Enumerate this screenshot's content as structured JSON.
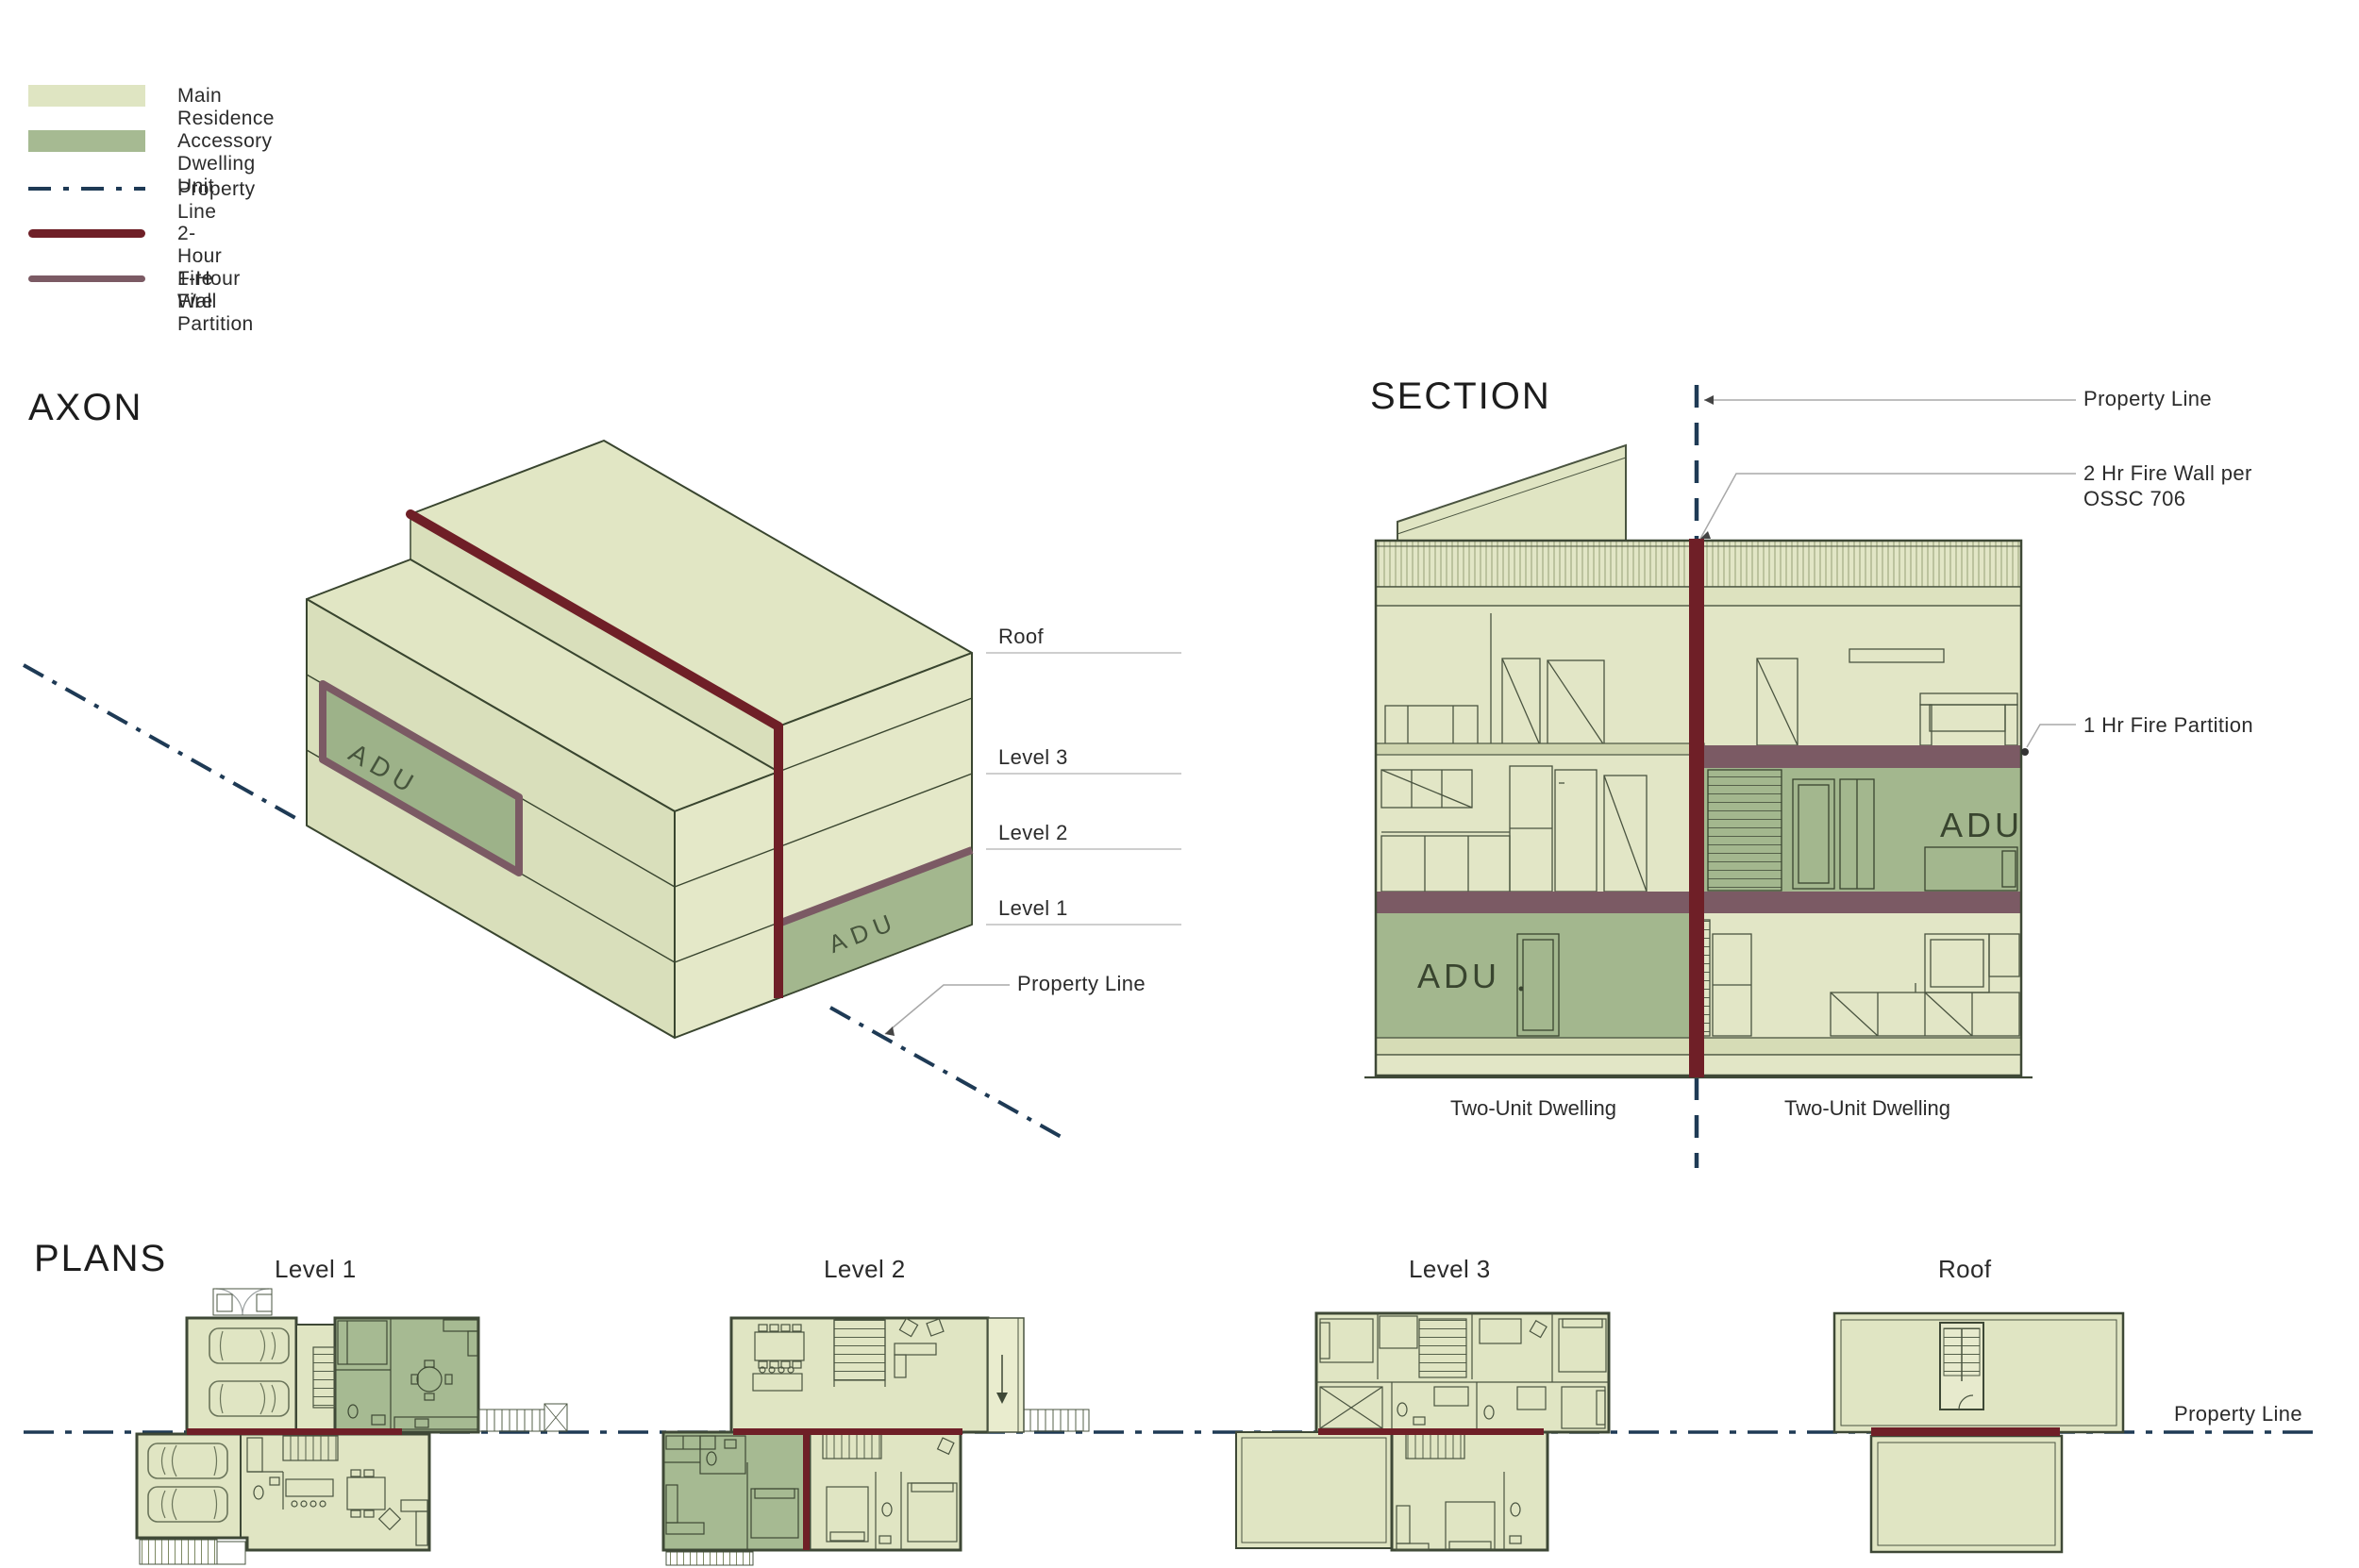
{
  "legend": {
    "items": [
      {
        "label": "Main Residence",
        "kind": "swatch",
        "color": "#dfe5c2"
      },
      {
        "label": "Accessory Dwelling Unit",
        "kind": "swatch",
        "color": "#a6ba92"
      },
      {
        "label": "Property Line",
        "kind": "dash",
        "color": "#1e3a55"
      },
      {
        "label": "2-Hour Fire Wall",
        "kind": "thick",
        "color": "#6f1f27"
      },
      {
        "label": "1-Hour Fire Partition",
        "kind": "thick",
        "color": "#7b5a64"
      }
    ]
  },
  "axon": {
    "title": "AXON",
    "levels": [
      {
        "label": "Roof"
      },
      {
        "label": "Level 3"
      },
      {
        "label": "Level 2"
      },
      {
        "label": "Level 1"
      }
    ],
    "property_line_label": "Property Line",
    "adu_wall_panel_label": "ADU",
    "adu_corner_label": "ADU"
  },
  "section": {
    "title": "SECTION",
    "labels": {
      "property_line": "Property Line",
      "fire_wall_line1": "2 Hr Fire Wall per",
      "fire_wall_line2": "OSSC 706",
      "fire_partition": "1 Hr Fire Partition"
    },
    "adu_upper_label": "ADU",
    "adu_lower_label": "ADU",
    "captions": {
      "left": "Two-Unit Dwelling",
      "right": "Two-Unit Dwelling"
    }
  },
  "plans": {
    "title": "PLANS",
    "sheets": [
      {
        "label": "Level 1"
      },
      {
        "label": "Level 2"
      },
      {
        "label": "Level 3"
      },
      {
        "label": "Roof"
      }
    ],
    "property_line_label": "Property Line"
  },
  "colors": {
    "main_residence": "#dfe5c2",
    "adu": "#a6ba92",
    "fire_wall": "#6f1f27",
    "fire_partition": "#7b5a64",
    "property_line": "#1e3a55"
  }
}
